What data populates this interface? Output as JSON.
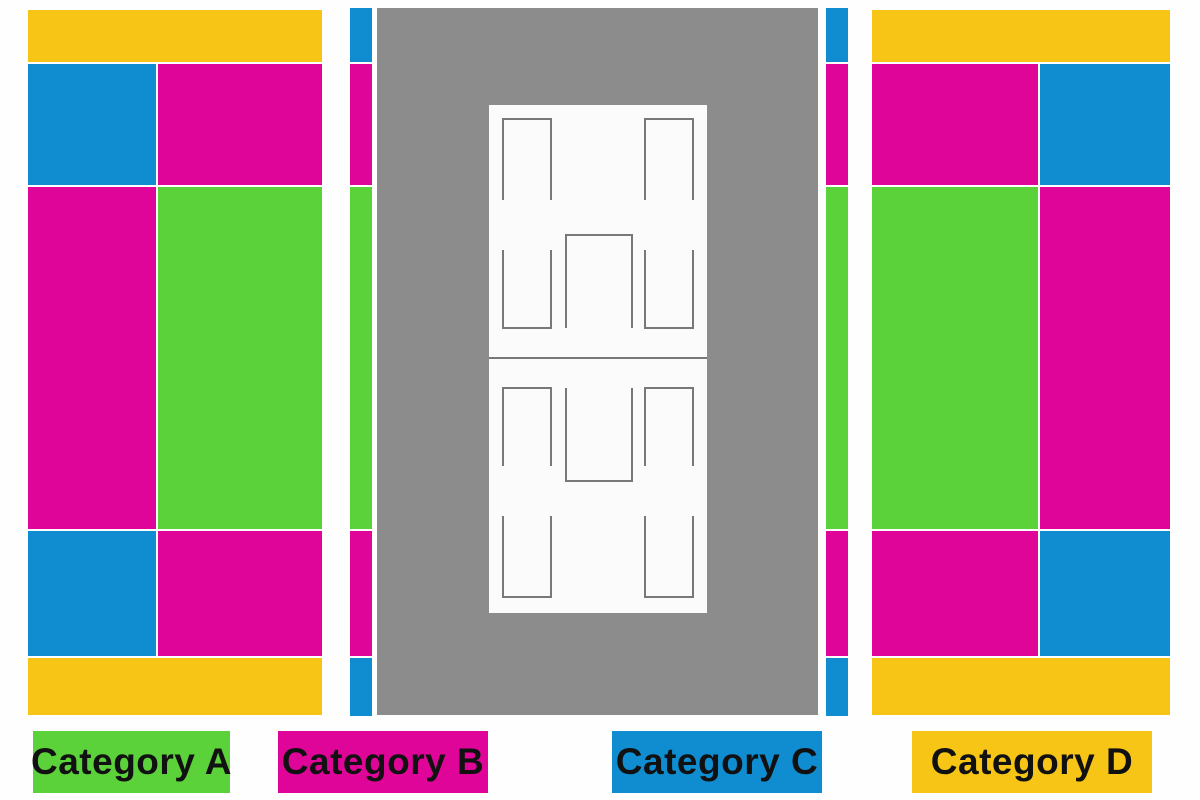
{
  "colors": {
    "background": "#FEFEFE",
    "category_a": "#5BD23A",
    "category_b": "#E00599",
    "category_c": "#0F8DD0",
    "category_d": "#F6C515",
    "court_surround": "#8C8C8C",
    "court_surface": "#FBFBFB",
    "court_line": "#787878",
    "legend_text": "#111111"
  },
  "legend": {
    "items": [
      {
        "label": "Category A",
        "category": "A",
        "color": "#5BD23A"
      },
      {
        "label": "Category B",
        "category": "B",
        "color": "#E00599"
      },
      {
        "label": "Category C",
        "category": "C",
        "color": "#0F8DD0"
      },
      {
        "label": "Category D",
        "category": "D",
        "color": "#F6C515"
      }
    ]
  },
  "seat_map": {
    "left_stand": {
      "blocks": [
        {
          "section": "top-bar",
          "category": "D",
          "color": "#F6C515"
        },
        {
          "section": "upper-outer",
          "category": "C",
          "color": "#0F8DD0"
        },
        {
          "section": "upper-inner",
          "category": "B",
          "color": "#E00599"
        },
        {
          "section": "middle-outer",
          "category": "B",
          "color": "#E00599"
        },
        {
          "section": "middle-inner",
          "category": "A",
          "color": "#5BD23A"
        },
        {
          "section": "lower-outer",
          "category": "C",
          "color": "#0F8DD0"
        },
        {
          "section": "lower-inner",
          "category": "B",
          "color": "#E00599"
        },
        {
          "section": "bottom-bar",
          "category": "D",
          "color": "#F6C515"
        }
      ]
    },
    "courtside_left_strip": {
      "blocks": [
        {
          "section": "top",
          "category": "C",
          "color": "#0F8DD0"
        },
        {
          "section": "upper",
          "category": "B",
          "color": "#E00599"
        },
        {
          "section": "middle",
          "category": "A",
          "color": "#5BD23A"
        },
        {
          "section": "lower",
          "category": "B",
          "color": "#E00599"
        },
        {
          "section": "bottom",
          "category": "C",
          "color": "#0F8DD0"
        }
      ]
    },
    "courtside_right_strip": {
      "blocks": [
        {
          "section": "top",
          "category": "C",
          "color": "#0F8DD0"
        },
        {
          "section": "upper",
          "category": "B",
          "color": "#E00599"
        },
        {
          "section": "middle",
          "category": "A",
          "color": "#5BD23A"
        },
        {
          "section": "lower",
          "category": "B",
          "color": "#E00599"
        },
        {
          "section": "bottom",
          "category": "C",
          "color": "#0F8DD0"
        }
      ]
    },
    "right_stand": {
      "blocks": [
        {
          "section": "top-bar",
          "category": "D",
          "color": "#F6C515"
        },
        {
          "section": "upper-inner",
          "category": "B",
          "color": "#E00599"
        },
        {
          "section": "upper-outer",
          "category": "C",
          "color": "#0F8DD0"
        },
        {
          "section": "middle-inner",
          "category": "A",
          "color": "#5BD23A"
        },
        {
          "section": "middle-outer",
          "category": "B",
          "color": "#E00599"
        },
        {
          "section": "lower-inner",
          "category": "B",
          "color": "#E00599"
        },
        {
          "section": "lower-outer",
          "category": "C",
          "color": "#0F8DD0"
        },
        {
          "section": "bottom-bar",
          "category": "D",
          "color": "#F6C515"
        }
      ]
    },
    "court": {
      "surround_color": "#8C8C8C",
      "surface_color": "#FBFBFB",
      "line_color": "#787878"
    }
  }
}
